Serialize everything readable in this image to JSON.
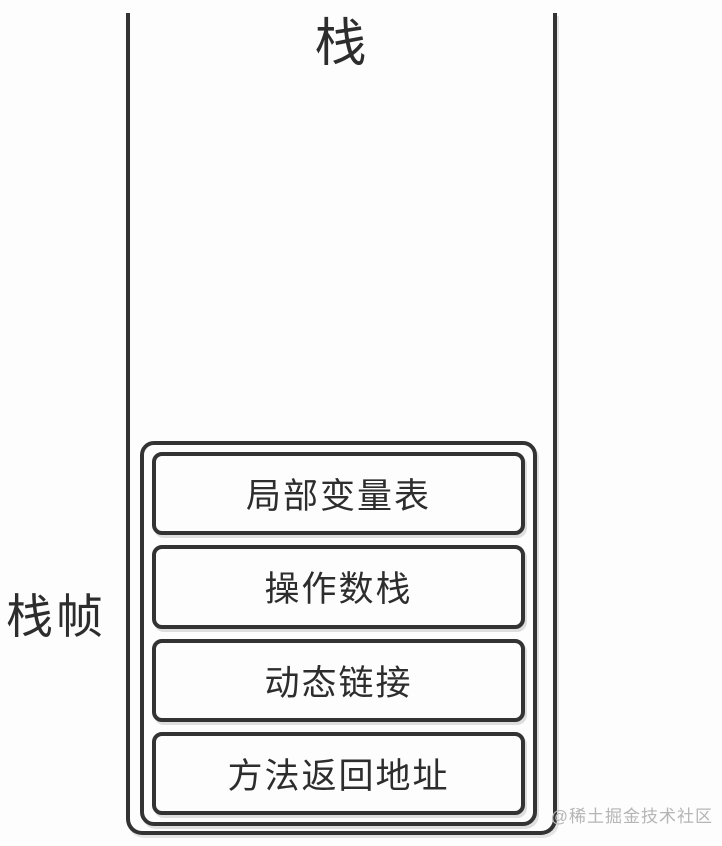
{
  "diagram": {
    "title": "栈",
    "frame_label": "栈帧",
    "frame_items": [
      "局部变量表",
      "操作数栈",
      "动态链接",
      "方法返回地址"
    ],
    "watermark": "@稀土掘金技术社区",
    "colors": {
      "line": "#333333",
      "text": "#2d2d2d",
      "watermark": "#b5b5b5",
      "background": "#fdfdfd"
    }
  }
}
